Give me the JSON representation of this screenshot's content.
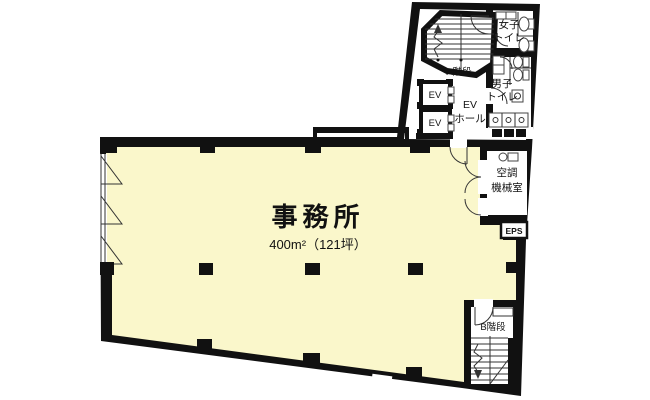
{
  "rooms": {
    "office": {
      "name": "事務所",
      "area": "400m²（121坪）"
    },
    "stairs_a": {
      "name": "A階段"
    },
    "stairs_b": {
      "name": "B階段"
    },
    "womens_toilet": {
      "line1": "女子",
      "line2": "トイレ"
    },
    "mens_toilet": {
      "line1": "男子",
      "line2": "トイレ"
    },
    "ev_hall": {
      "line1": "EV",
      "line2": "ホール"
    },
    "elevator": {
      "name": "EV"
    },
    "hvac": {
      "line1": "空調",
      "line2": "機械室"
    },
    "eps": {
      "name": "EPS"
    }
  },
  "colors": {
    "wall": "#111111",
    "office_floor": "#FAF7CB",
    "room_floor": "#FFFFFF",
    "line": "#333333"
  }
}
